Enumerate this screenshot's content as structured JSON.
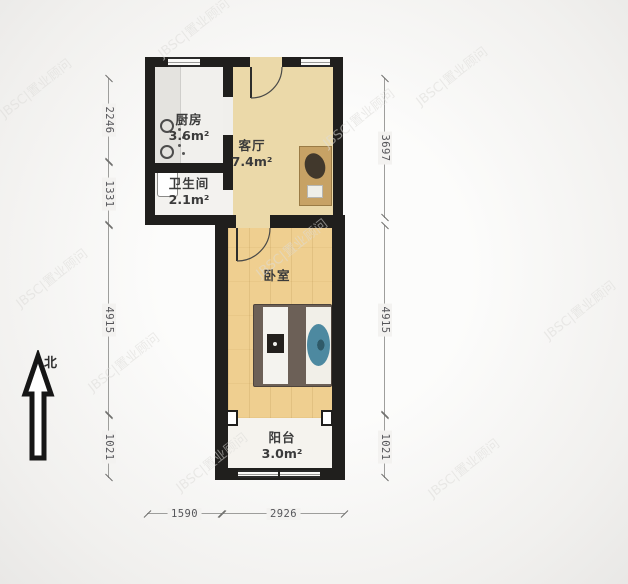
{
  "compass": {
    "label": "北"
  },
  "watermark": {
    "text": "JBSC|置业顾问"
  },
  "rooms": {
    "kitchen": {
      "name": "厨房",
      "area": "3.6m²"
    },
    "living": {
      "name": "客厅",
      "area": "7.4m²"
    },
    "bathroom": {
      "name": "卫生间",
      "area": "2.1m²"
    },
    "bedroom": {
      "name": "卧室"
    },
    "balcony": {
      "name": "阳台",
      "area": "3.0m²"
    }
  },
  "dimensions": {
    "left": [
      "2246",
      "1331",
      "4915",
      "1021"
    ],
    "right": [
      "3697",
      "4915",
      "1021"
    ],
    "bottom": [
      "1590",
      "2926"
    ]
  },
  "colors": {
    "wall": "#201f1d",
    "living_floor": "#ebd9a9",
    "bedroom_floor": "#efcf90",
    "balcony_floor": "#f5f3ee",
    "cabinet": "#c7a265",
    "bed_teal": "#4d89a0"
  }
}
